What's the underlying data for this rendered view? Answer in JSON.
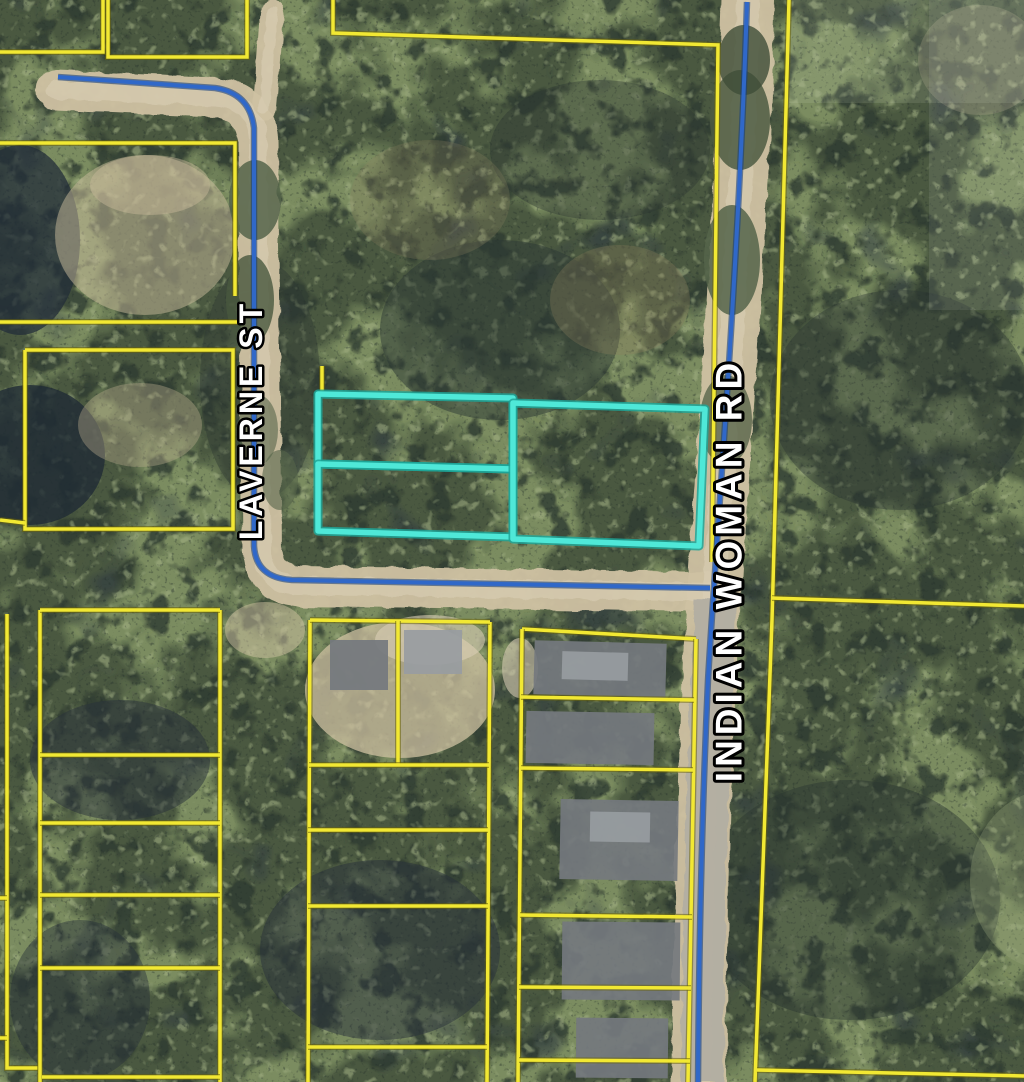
{
  "map": {
    "width": 1024,
    "height": 1082,
    "colors": {
      "canopy_base": "#7b8c60",
      "canopy_dark": "#44523c",
      "canopy_shadow": "#2e3a30",
      "canopy_light": "#a3b184",
      "canopy_grain": "#232e2a",
      "shadow_navy": "#2a3440",
      "dirt": "#cfc1a2",
      "dirt_light": "#dbcfb6",
      "pavement": "#b2aea2",
      "parcel_line": "#f2e833",
      "parcel_casing": "#6b640a",
      "road_line": "#3068c8",
      "road_casing": "#17407e",
      "highlight": "#4fe8d8",
      "highlight_casing": "#1fa598",
      "label_fill": "#ffffff",
      "label_stroke": "#000000",
      "roof": "#74787e",
      "roof_light": "#989ca1"
    },
    "street_labels": [
      {
        "id": "laverne-st",
        "text": "LAVERNE ST",
        "x": 251,
        "y": 420,
        "rotation": -90,
        "font_size": 32,
        "letter_spacing": 4,
        "stroke_width": 5
      },
      {
        "id": "indian-woman-rd",
        "text": "INDIAN WOMAN RD",
        "x": 729,
        "y": 570,
        "rotation": -90,
        "font_size": 37,
        "letter_spacing": 5,
        "stroke_width": 6
      }
    ],
    "roads": {
      "dirt_paths": [
        {
          "id": "laverne-st-roadbed",
          "d": "M56,90 L215,97 Q254,102 258,138 L262,552 Q265,584 298,586 L716,592",
          "width": 40
        },
        {
          "id": "laverne-north-stub",
          "d": "M272,12 L265,108",
          "width": 24
        },
        {
          "id": "indian-woman-roadbed",
          "d": "M748,0 C740,260 718,520 710,660 C704,780 700,930 699,1082",
          "width": 54
        }
      ],
      "paved_paths": [
        {
          "id": "indian-woman-pavement",
          "d": "M716,600 C708,760 703,900 702,1082",
          "width": 42
        }
      ],
      "centerlines": [
        {
          "id": "laverne-centerline",
          "d": "M58,77 L215,88 Q250,93 254,128 L254,546 Q256,578 292,580 L710,588"
        },
        {
          "id": "indian-woman-centerline",
          "d": "M747,2 C738,280 716,540 708,680 C703,790 699,940 698,1082"
        }
      ]
    },
    "parcel_lines": [
      {
        "pts": [
          [
            108,
            0
          ],
          [
            108,
            57
          ],
          [
            247,
            57
          ],
          [
            247,
            0
          ]
        ]
      },
      {
        "pts": [
          [
            0,
            52
          ],
          [
            103,
            52
          ],
          [
            103,
            0
          ]
        ]
      },
      {
        "pts": [
          [
            0,
            143
          ],
          [
            235,
            143
          ],
          [
            235,
            296
          ]
        ]
      },
      {
        "pts": [
          [
            0,
            322
          ],
          [
            238,
            322
          ]
        ]
      },
      {
        "pts": [
          [
            25,
            350
          ],
          [
            233,
            350
          ],
          [
            233,
            529
          ],
          [
            25,
            529
          ],
          [
            25,
            350
          ]
        ]
      },
      {
        "pts": [
          [
            0,
            520
          ],
          [
            25,
            523
          ]
        ]
      },
      {
        "pts": [
          [
            333,
            0
          ],
          [
            333,
            33
          ],
          [
            718,
            45
          ],
          [
            712,
            562
          ]
        ]
      },
      {
        "pts": [
          [
            322,
            366
          ],
          [
            322,
            391
          ]
        ]
      },
      {
        "pts": [
          [
            789,
            0
          ],
          [
            772,
            620
          ],
          [
            755,
            1082
          ]
        ]
      },
      {
        "pts": [
          [
            772,
            598
          ],
          [
            1024,
            606
          ]
        ]
      },
      {
        "pts": [
          [
            757,
            1070
          ],
          [
            1024,
            1076
          ]
        ]
      },
      {
        "pts": [
          [
            7,
            614
          ],
          [
            7,
            1068
          ],
          [
            38,
            1068
          ]
        ]
      },
      {
        "pts": [
          [
            0,
            898
          ],
          [
            7,
            898
          ]
        ]
      },
      {
        "pts": [
          [
            0,
            1038
          ],
          [
            7,
            1038
          ]
        ]
      },
      {
        "pts": [
          [
            40,
            610
          ],
          [
            40,
            1082
          ]
        ]
      },
      {
        "pts": [
          [
            220,
            610
          ],
          [
            220,
            1082
          ]
        ]
      },
      {
        "pts": [
          [
            40,
            610
          ],
          [
            220,
            610
          ]
        ]
      },
      {
        "pts": [
          [
            40,
            755
          ],
          [
            220,
            755
          ]
        ]
      },
      {
        "pts": [
          [
            40,
            823
          ],
          [
            220,
            823
          ]
        ]
      },
      {
        "pts": [
          [
            40,
            895
          ],
          [
            220,
            895
          ]
        ]
      },
      {
        "pts": [
          [
            40,
            968
          ],
          [
            220,
            968
          ]
        ]
      },
      {
        "pts": [
          [
            42,
            1077
          ],
          [
            220,
            1077
          ]
        ]
      },
      {
        "pts": [
          [
            310,
            620
          ],
          [
            308,
            1082
          ]
        ]
      },
      {
        "pts": [
          [
            490,
            622
          ],
          [
            487,
            1082
          ]
        ]
      },
      {
        "pts": [
          [
            310,
            620
          ],
          [
            490,
            622
          ]
        ]
      },
      {
        "pts": [
          [
            398,
            621
          ],
          [
            398,
            765
          ]
        ]
      },
      {
        "pts": [
          [
            309,
            765
          ],
          [
            489,
            765
          ]
        ]
      },
      {
        "pts": [
          [
            308,
            830
          ],
          [
            488,
            830
          ]
        ]
      },
      {
        "pts": [
          [
            308,
            906
          ],
          [
            488,
            906
          ]
        ]
      },
      {
        "pts": [
          [
            308,
            1047
          ],
          [
            487,
            1047
          ]
        ]
      },
      {
        "pts": [
          [
            522,
            629
          ],
          [
            696,
            639
          ]
        ]
      },
      {
        "pts": [
          [
            522,
            629
          ],
          [
            518,
            1082
          ]
        ]
      },
      {
        "pts": [
          [
            696,
            639
          ],
          [
            688,
            1082
          ]
        ]
      },
      {
        "pts": [
          [
            521,
            697
          ],
          [
            694,
            700
          ]
        ]
      },
      {
        "pts": [
          [
            521,
            768
          ],
          [
            693,
            770
          ]
        ]
      },
      {
        "pts": [
          [
            520,
            915
          ],
          [
            692,
            917
          ]
        ]
      },
      {
        "pts": [
          [
            519,
            987
          ],
          [
            691,
            988
          ]
        ]
      },
      {
        "pts": [
          [
            519,
            1060
          ],
          [
            690,
            1061
          ]
        ]
      }
    ],
    "highlight_parcels": [
      {
        "id": "highlight-parcel-nw",
        "pts": [
          [
            318,
            394
          ],
          [
            513,
            398
          ],
          [
            513,
            469
          ],
          [
            318,
            464
          ]
        ]
      },
      {
        "id": "highlight-parcel-sw",
        "pts": [
          [
            318,
            464
          ],
          [
            513,
            469
          ],
          [
            513,
            537
          ],
          [
            318,
            531
          ]
        ]
      },
      {
        "id": "highlight-parcel-east",
        "pts": [
          [
            513,
            403
          ],
          [
            705,
            409
          ],
          [
            699,
            546
          ],
          [
            513,
            539
          ]
        ]
      }
    ],
    "houses": [
      {
        "x": 534,
        "y": 642,
        "w": 132,
        "h": 54,
        "rot": 1.5,
        "fill": "roof"
      },
      {
        "x": 562,
        "y": 652,
        "w": 66,
        "h": 28,
        "rot": 1.5,
        "fill": "roof_light"
      },
      {
        "x": 526,
        "y": 712,
        "w": 128,
        "h": 52,
        "rot": 1,
        "fill": "roof"
      },
      {
        "x": 560,
        "y": 800,
        "w": 118,
        "h": 80,
        "rot": 1,
        "fill": "roof"
      },
      {
        "x": 590,
        "y": 812,
        "w": 60,
        "h": 30,
        "rot": 1,
        "fill": "roof_light"
      },
      {
        "x": 562,
        "y": 922,
        "w": 118,
        "h": 78,
        "rot": 0.5,
        "fill": "roof"
      },
      {
        "x": 576,
        "y": 1018,
        "w": 92,
        "h": 60,
        "rot": 0.5,
        "fill": "roof"
      },
      {
        "x": 330,
        "y": 640,
        "w": 58,
        "h": 50,
        "rot": 0,
        "fill": "roof"
      },
      {
        "x": 404,
        "y": 630,
        "w": 58,
        "h": 44,
        "rot": 0,
        "fill": "roof_light"
      }
    ],
    "clearings": [
      {
        "cx": 145,
        "cy": 235,
        "rx": 90,
        "ry": 80,
        "fill": "#c9bb9c",
        "opacity": 0.5
      },
      {
        "cx": 150,
        "cy": 185,
        "rx": 60,
        "ry": 30,
        "fill": "#c9bb9c",
        "opacity": 0.45
      },
      {
        "cx": 140,
        "cy": 425,
        "rx": 62,
        "ry": 42,
        "fill": "#b7ab8d",
        "opacity": 0.4
      },
      {
        "cx": 400,
        "cy": 690,
        "rx": 95,
        "ry": 68,
        "fill": "#cfc1a2",
        "opacity": 0.75
      },
      {
        "cx": 430,
        "cy": 640,
        "rx": 55,
        "ry": 25,
        "fill": "#dbcfb6",
        "opacity": 0.6
      },
      {
        "cx": 265,
        "cy": 630,
        "rx": 40,
        "ry": 28,
        "fill": "#cfc1a2",
        "opacity": 0.5
      },
      {
        "cx": 520,
        "cy": 668,
        "rx": 18,
        "ry": 30,
        "fill": "#dbcfb6",
        "opacity": 0.6
      },
      {
        "cx": 980,
        "cy": 60,
        "rx": 62,
        "ry": 55,
        "fill": "#c9bb9c",
        "opacity": 0.22
      },
      {
        "cx": 620,
        "cy": 300,
        "rx": 70,
        "ry": 55,
        "fill": "#8a7f5e",
        "opacity": 0.3
      },
      {
        "cx": 430,
        "cy": 200,
        "rx": 80,
        "ry": 60,
        "fill": "#8a7f5e",
        "opacity": 0.25
      },
      {
        "cx": 1050,
        "cy": 880,
        "rx": 80,
        "ry": 90,
        "fill": "#9aa87e",
        "opacity": 0.3
      }
    ],
    "dark_patches": [
      {
        "cx": 20,
        "cy": 240,
        "rx": 60,
        "ry": 95,
        "fill": "#222c38",
        "opacity": 0.75
      },
      {
        "cx": 30,
        "cy": 455,
        "rx": 75,
        "ry": 70,
        "fill": "#1f2a35",
        "opacity": 0.8
      },
      {
        "cx": 120,
        "cy": 760,
        "rx": 90,
        "ry": 60,
        "fill": "#273039",
        "opacity": 0.5
      },
      {
        "cx": 80,
        "cy": 1000,
        "rx": 70,
        "ry": 80,
        "fill": "#273039",
        "opacity": 0.45
      },
      {
        "cx": 500,
        "cy": 330,
        "rx": 120,
        "ry": 90,
        "fill": "#2c3833",
        "opacity": 0.5
      },
      {
        "cx": 600,
        "cy": 150,
        "rx": 110,
        "ry": 70,
        "fill": "#2c3833",
        "opacity": 0.4
      },
      {
        "cx": 900,
        "cy": 400,
        "rx": 130,
        "ry": 110,
        "fill": "#2a3531",
        "opacity": 0.4
      },
      {
        "cx": 850,
        "cy": 900,
        "rx": 150,
        "ry": 120,
        "fill": "#2a3531",
        "opacity": 0.45
      },
      {
        "cx": 380,
        "cy": 950,
        "rx": 120,
        "ry": 90,
        "fill": "#273039",
        "opacity": 0.5
      },
      {
        "cx": 260,
        "cy": 380,
        "rx": 60,
        "ry": 120,
        "fill": "#2c3833",
        "opacity": 0.4
      }
    ],
    "overgrowth": [
      {
        "cx": 255,
        "cy": 200,
        "rx": 26,
        "ry": 40,
        "fill": "#55644a",
        "opacity": 0.85
      },
      {
        "cx": 250,
        "cy": 300,
        "rx": 24,
        "ry": 45,
        "fill": "#49583f",
        "opacity": 0.8
      },
      {
        "cx": 258,
        "cy": 430,
        "rx": 20,
        "ry": 35,
        "fill": "#55644a",
        "opacity": 0.6
      },
      {
        "cx": 740,
        "cy": 120,
        "rx": 30,
        "ry": 50,
        "fill": "#4c5a42",
        "opacity": 0.85
      },
      {
        "cx": 732,
        "cy": 260,
        "rx": 28,
        "ry": 55,
        "fill": "#55644a",
        "opacity": 0.85
      },
      {
        "cx": 726,
        "cy": 420,
        "rx": 26,
        "ry": 45,
        "fill": "#49583f",
        "opacity": 0.7
      },
      {
        "cx": 744,
        "cy": 60,
        "rx": 26,
        "ry": 35,
        "fill": "#3f4d38",
        "opacity": 0.8
      },
      {
        "cx": 280,
        "cy": 480,
        "rx": 18,
        "ry": 30,
        "fill": "#55644a",
        "opacity": 0.6
      }
    ],
    "seams": [
      {
        "x": 929,
        "y": 0,
        "w": 95,
        "h": 310,
        "fill": "#ffffff",
        "opacity": 0.08
      },
      {
        "x": 789,
        "y": 0,
        "w": 235,
        "h": 103,
        "fill": "#d8dbc8",
        "opacity": 0.12
      }
    ]
  }
}
